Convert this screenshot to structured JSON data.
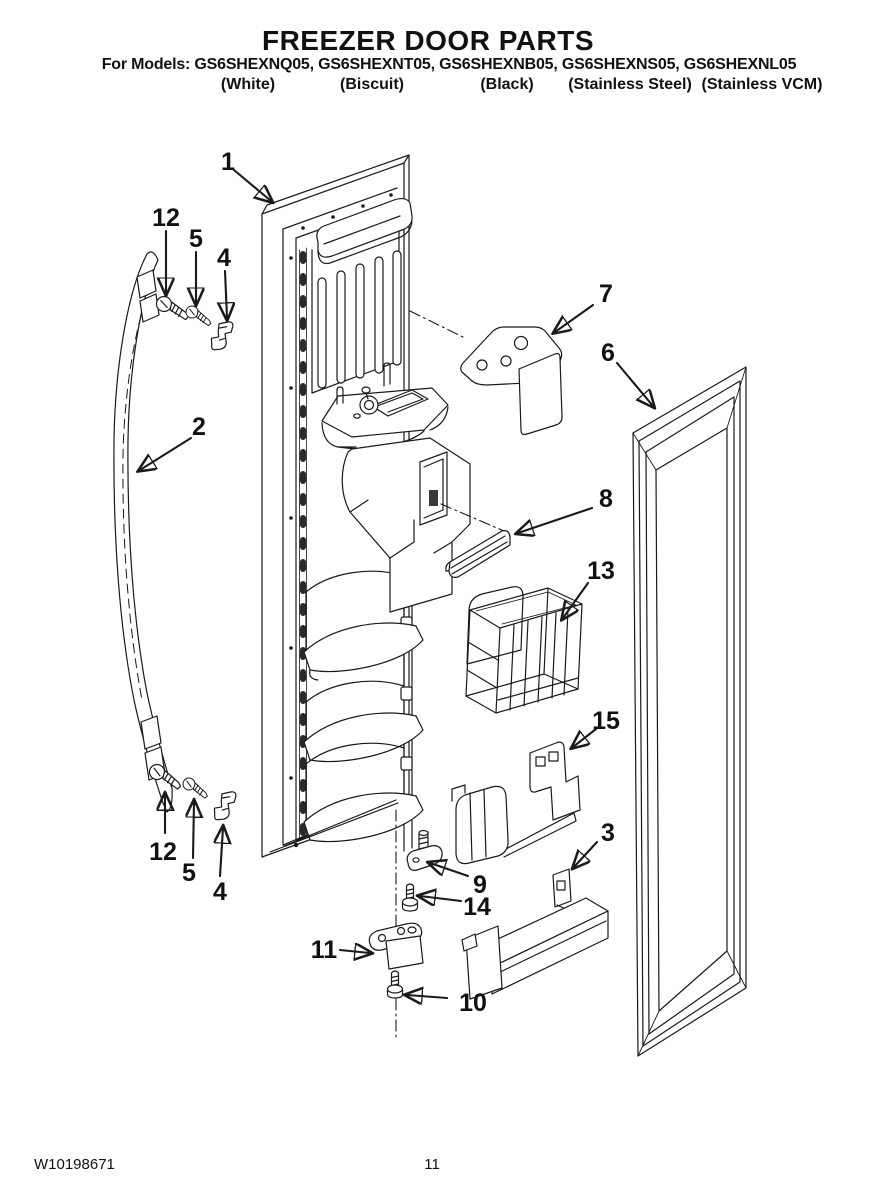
{
  "header": {
    "title": "FREEZER DOOR PARTS",
    "models_line": "For Models: GS6SHEXNQ05, GS6SHEXNT05, GS6SHEXNB05, GS6SHEXNS05, GS6SHEXNL05",
    "finishes": [
      "(White)",
      "(Biscuit)",
      "(Black)",
      "(Stainless Steel)",
      "(Stainless VCM)"
    ]
  },
  "diagram": {
    "line_color": "#1a1a1a",
    "callouts": [
      {
        "label": "1"
      },
      {
        "label": "12"
      },
      {
        "label": "5"
      },
      {
        "label": "4"
      },
      {
        "label": "2"
      },
      {
        "label": "7"
      },
      {
        "label": "6"
      },
      {
        "label": "8"
      },
      {
        "label": "13"
      },
      {
        "label": "15"
      },
      {
        "label": "3"
      },
      {
        "label": "9"
      },
      {
        "label": "14"
      },
      {
        "label": "11"
      },
      {
        "label": "10"
      },
      {
        "label": "12"
      },
      {
        "label": "5"
      },
      {
        "label": "4"
      }
    ]
  },
  "footer": {
    "doc_number": "W10198671",
    "page_number": "11"
  }
}
